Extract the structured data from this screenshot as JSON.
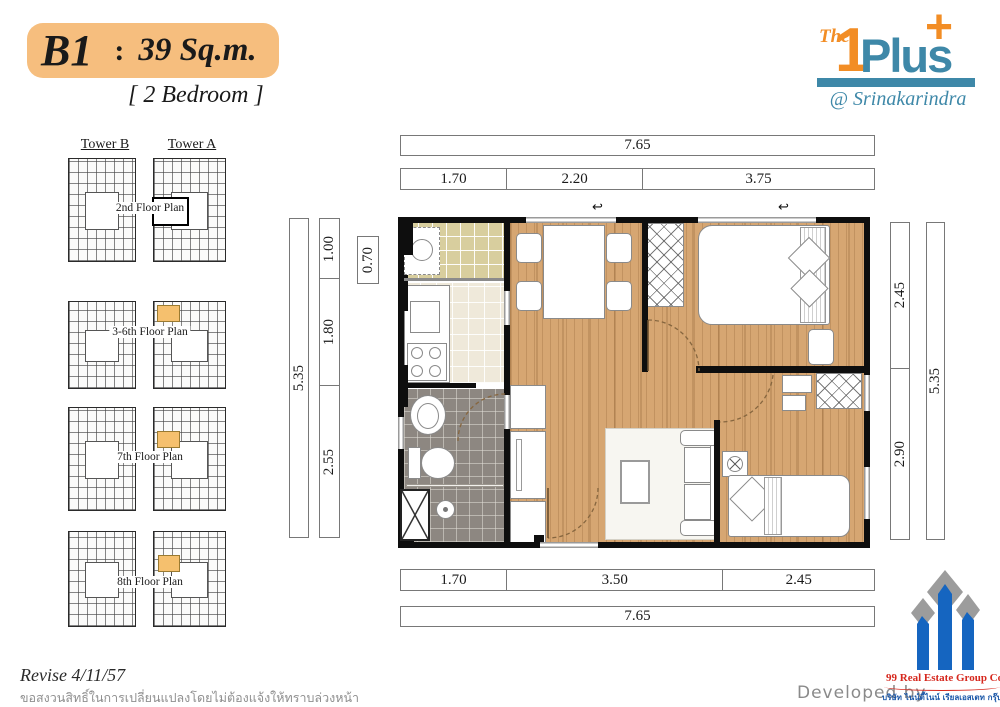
{
  "header": {
    "unit_code": "B1",
    "colon": ":",
    "area": "39 Sq.m.",
    "bedroom_label": "[ 2 Bedroom ]",
    "badge_color": "#F6BE7E"
  },
  "brand": {
    "the": "The",
    "one": "1",
    "plus": "Plus",
    "plus_sign": "+",
    "location": "@ Srinakarindra",
    "blue": "#3E88A8",
    "orange": "#F28D25"
  },
  "tower_panel": {
    "tower_b": "Tower B",
    "tower_a": "Tower A",
    "highlight_color": "#F5C06E",
    "floors": [
      {
        "label": "2nd Floor Plan",
        "highlight": "black-outline"
      },
      {
        "label": "3-6th Floor Plan",
        "highlight": "orange"
      },
      {
        "label": "7th Floor Plan",
        "highlight": "orange"
      },
      {
        "label": "8th Floor Plan",
        "highlight": "orange"
      }
    ]
  },
  "dimensions": {
    "top_total": "7.65",
    "top_segments": [
      "1.70",
      "2.20",
      "3.75"
    ],
    "left_outer": "5.35",
    "left_segments": [
      "1.00",
      "1.80",
      "2.55"
    ],
    "left_inner": "0.70",
    "right_segments": [
      "2.45",
      "2.90"
    ],
    "right_outer": "5.35",
    "bottom_segments": [
      "1.70",
      "3.50",
      "2.45"
    ],
    "bottom_total": "7.65"
  },
  "footer": {
    "revise_note": "Revise 4/11/57",
    "disclaimer_th": "ขอสงวนสิทธิ์ในการเปลี่ยนแปลงโดยไม่ต้องแจ้งให้ทราบล่วงหน้า",
    "developed_by": "Developed by"
  },
  "developer": {
    "name_en": "99 Real Estate Group Co.,Ltd",
    "name_th": "บริษัท ไนน์ตี้ไนน์ เรียลเอสเตท กรุ๊ป จำกัด",
    "red": "#D6281E",
    "blue": "#1A57A8"
  }
}
